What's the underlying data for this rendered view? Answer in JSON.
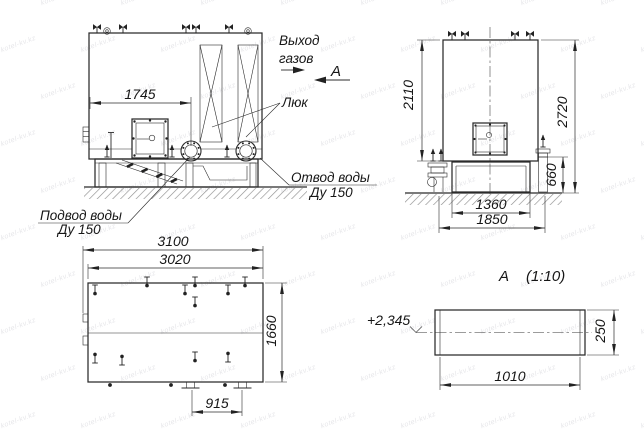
{
  "watermark": {
    "text": "kotel-kv.kz"
  },
  "front_view": {
    "dims": {
      "flange_offset": "1745"
    },
    "labels": {
      "gas_outlet_line1": "Выход",
      "gas_outlet_line2": "газов",
      "view_arrow": "А",
      "hatch": "Люк",
      "water_outlet": "Отвод воды",
      "water_outlet_dn": "Ду 150",
      "water_supply": "Подвод воды",
      "water_supply_dn": "Ду 150"
    }
  },
  "side_view": {
    "dims": {
      "body_height": "2110",
      "total_height": "2720",
      "base_height": "660",
      "base_width": "1360",
      "overall_width": "1850"
    }
  },
  "top_view": {
    "dims": {
      "overall_length": "3100",
      "body_length": "3020",
      "width": "1660",
      "feet_spacing": "915"
    }
  },
  "detail_a": {
    "title": "А",
    "scale": "(1:10)",
    "elevation_mark": "+2,345",
    "dims": {
      "length": "1010",
      "height": "250"
    }
  }
}
